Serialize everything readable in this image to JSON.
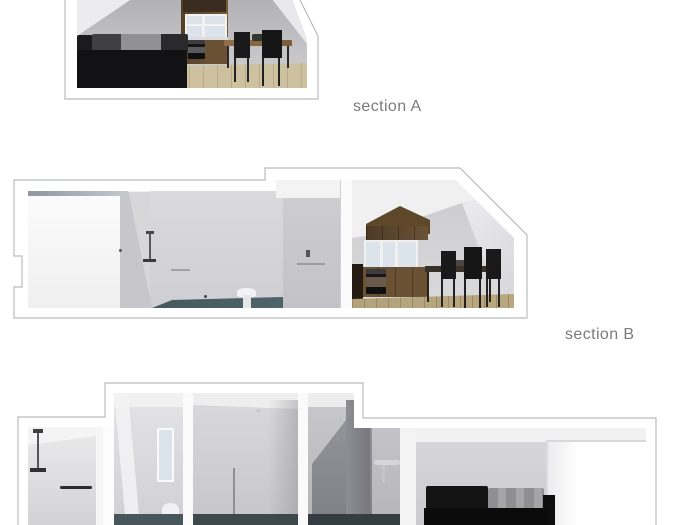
{
  "canvas": {
    "width": 700,
    "height": 525,
    "background": "#ffffff"
  },
  "labels": {
    "section_a": "section A",
    "section_b": "section B"
  },
  "colors": {
    "page_bg": "#ffffff",
    "label_text": "#7b7b7b",
    "outline": "#b7babe",
    "wall_gray": "#c6c6ca",
    "ceiling_white": "#f1f1f2",
    "wood_cabinet": "#6b5134",
    "wood_dark": "#3a2d20",
    "wood_floor": "#cdc1a0",
    "wood_floor_b": "#b9a87f",
    "sofa_black": "#141414",
    "cushion_gray": "#8f8f93",
    "chair_black": "#1a1a1a",
    "bathroom_floor_teal": "#4d6468",
    "window_glass": "#dde3ea"
  }
}
